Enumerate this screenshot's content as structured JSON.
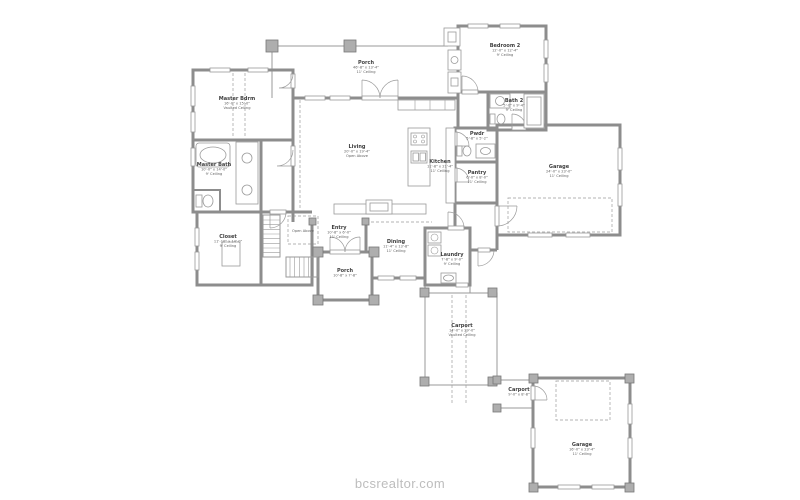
{
  "watermark": {
    "text": "bcsrealtor.com"
  },
  "colors": {
    "wall": "#8d8d8d",
    "wall_dark": "#787878",
    "line": "#9a9a9a",
    "dash": "#b3b3b3",
    "column": "#aeaeae",
    "label": "#3e3e3e",
    "label2": "#616161",
    "watermark": "#bdbdbd",
    "background": "#ffffff"
  },
  "rooms": [
    {
      "id": "back-porch",
      "name": "Porch",
      "dims": "46'-8\" x 13'-4\"",
      "ceiling": "11' Ceiling",
      "x": 366,
      "y": 64
    },
    {
      "id": "bedroom-2",
      "name": "Bedroom 2",
      "dims": "12'-0\" x 12'-4\"",
      "ceiling": "9' Ceiling",
      "x": 505,
      "y": 47
    },
    {
      "id": "bath-2",
      "name": "Bath 2",
      "dims": "5'-0\" x 9'-4\"",
      "ceiling": "9' Ceiling",
      "x": 514,
      "y": 102
    },
    {
      "id": "master-bdrm",
      "name": "Master Bdrm",
      "dims": "16'-0\" x 15'-0\"",
      "ceiling": "Vaulted Ceiling",
      "x": 237,
      "y": 100
    },
    {
      "id": "master-bath",
      "name": "Master Bath",
      "dims": "10'-0\" x 14'-0\"",
      "ceiling": "9' Ceiling",
      "x": 214,
      "y": 166
    },
    {
      "id": "closet",
      "name": "Closet",
      "dims": "11'-10\" x 14'-0\"",
      "ceiling": "9' Ceiling",
      "x": 228,
      "y": 238
    },
    {
      "id": "living",
      "name": "Living",
      "dims": "20'-0\" x 19'-4\"",
      "ceiling": "Open Above",
      "x": 357,
      "y": 148
    },
    {
      "id": "kitchen",
      "name": "Kitchen",
      "dims": "11'-8\" x 21'-4\"",
      "ceiling": "11' Ceiling",
      "x": 440,
      "y": 163
    },
    {
      "id": "pwdr",
      "name": "Pwdr",
      "dims": "5'-8\" x 5'-2\"",
      "ceiling": "",
      "x": 477,
      "y": 135
    },
    {
      "id": "pantry",
      "name": "Pantry",
      "dims": "6'-0\" x 8'-0\"",
      "ceiling": "11' Ceiling",
      "x": 477,
      "y": 174
    },
    {
      "id": "garage-attached",
      "name": "Garage",
      "dims": "24'-0\" x 23'-0\"",
      "ceiling": "11' Ceiling",
      "x": 559,
      "y": 168
    },
    {
      "id": "entry",
      "name": "Entry",
      "dims": "10'-8\" x 6'-0\"",
      "ceiling": "11' Ceiling",
      "x": 339,
      "y": 229
    },
    {
      "id": "dining",
      "name": "Dining",
      "dims": "11'-4\" x 13'-8\"",
      "ceiling": "11' Ceiling",
      "x": 396,
      "y": 243
    },
    {
      "id": "laundry",
      "name": "Laundry",
      "dims": "7'-8\" x 9'-0\"",
      "ceiling": "9' Ceiling",
      "x": 452,
      "y": 256
    },
    {
      "id": "front-porch",
      "name": "Porch",
      "dims": "10'-8\" x 7'-8\"",
      "ceiling": "",
      "x": 345,
      "y": 272
    },
    {
      "id": "carport-long",
      "name": "Carport",
      "dims": "14'-0\" x 29'-0\"",
      "ceiling": "Vaulted Ceiling",
      "x": 462,
      "y": 327
    },
    {
      "id": "carport-small",
      "name": "Carport",
      "dims": "9'-0\" x 8'-8\"",
      "ceiling": "",
      "x": 519,
      "y": 391
    },
    {
      "id": "garage-detached",
      "name": "Garage",
      "dims": "16'-0\" x 23'-4\"",
      "ceiling": "11' Ceiling",
      "x": 582,
      "y": 446
    }
  ],
  "notes": [
    {
      "id": "open-above",
      "text": "Open Above",
      "x": 303,
      "y": 232
    }
  ]
}
